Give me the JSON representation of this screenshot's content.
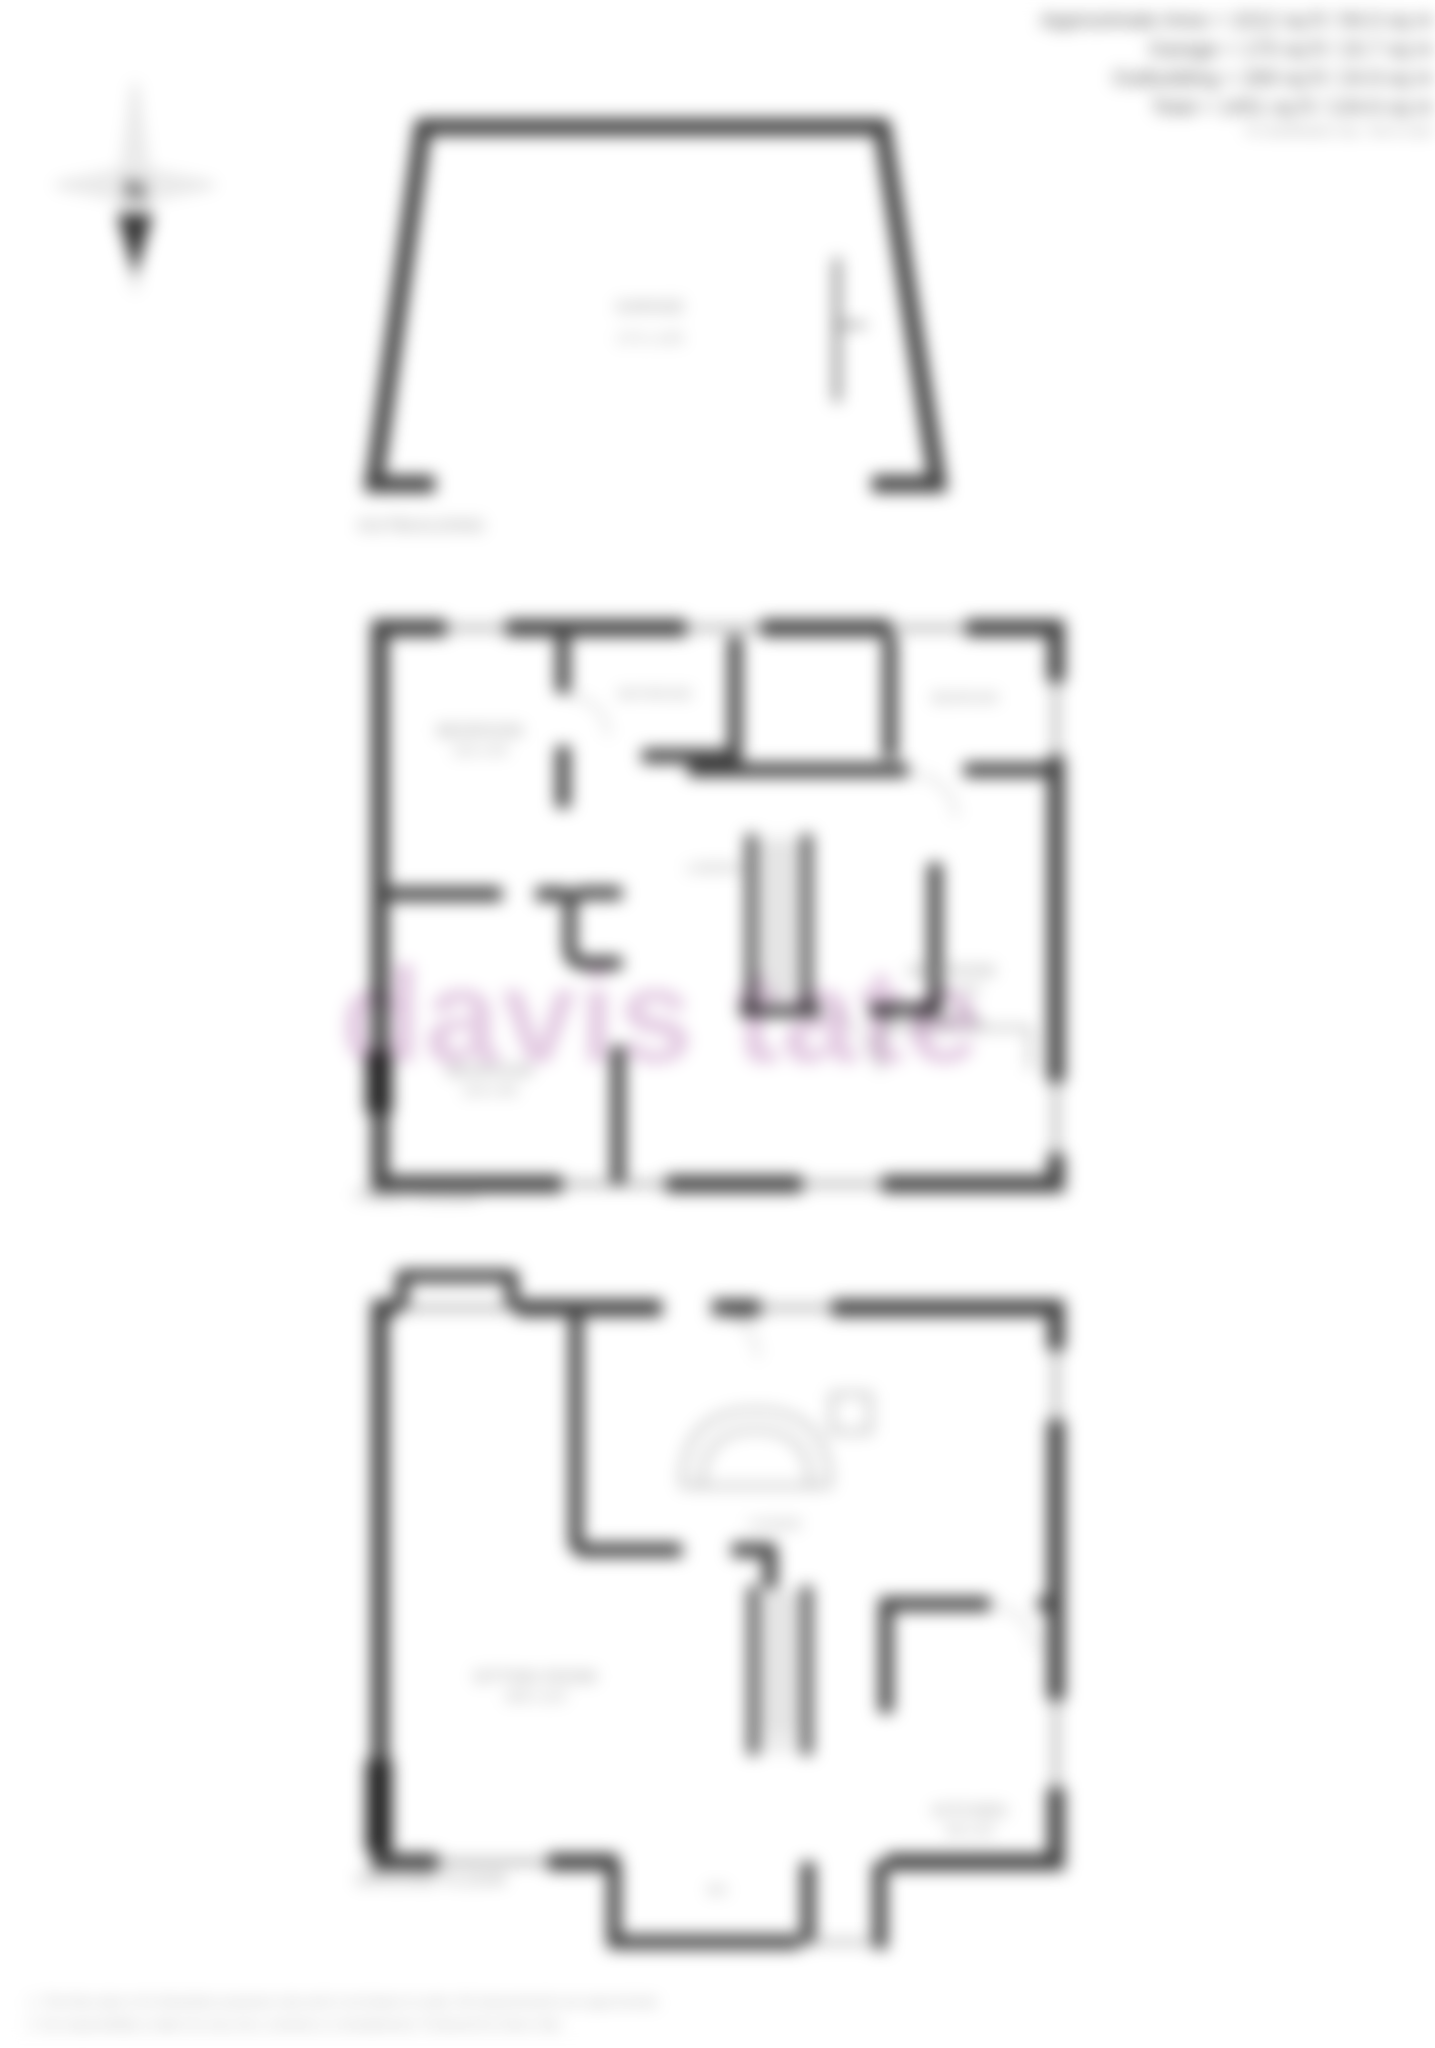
{
  "header": {
    "area": "Approximate Area = 1012 sq ft / 94.0 sq m",
    "garage": "Garage = 170 sq ft / 15.7 sq m",
    "outbuilding": "Outbuilding = 269 sq ft / 24.9 sq m",
    "total": "Total = 1451 sq ft / 134.6 sq m",
    "note": "For identification only - Not to scale"
  },
  "compass": {
    "north": "N"
  },
  "plans": {
    "outbuilding": {
      "label": "OUTBUILDING",
      "room_name": "GARAGE",
      "room_dims": "17'2 x 14'5"
    },
    "first": {
      "label": "FIRST FLOOR",
      "bed1": {
        "name": "BEDROOM",
        "dims": "11'5 x 9'3"
      },
      "bath": {
        "name": "BATHROOM"
      },
      "bed2": {
        "name": "BEDROOM"
      },
      "landing": {
        "name": "LANDING"
      },
      "bed3": {
        "name": "BEDROOM",
        "dims": "11'9 x 8'6"
      },
      "bed4": {
        "name": "BEDROOM",
        "dims": "12'0 x 9'6"
      }
    },
    "ground": {
      "label": "GROUND FLOOR",
      "sitting": {
        "name": "SITTING ROOM",
        "dims": "19'8 x 11'5"
      },
      "lounge": {
        "name": "LOUNGE"
      },
      "kitchen": {
        "name": "KITCHEN",
        "dims": "9'8 x 8'2"
      },
      "wc": {
        "name": "WC"
      }
    }
  },
  "watermark": "davis tate",
  "disclaimer": {
    "line1": "1. This floor plan is for illustrative purposes only and is not drawn to scale. All measurements are approximate.",
    "line2": "2. No responsibility is taken for any error, omission or misstatement. Produced for Davis Tate."
  },
  "colors": {
    "wall": "#3f3f3f",
    "label": "#8c8c8c",
    "watermark": "#c79ac5"
  }
}
